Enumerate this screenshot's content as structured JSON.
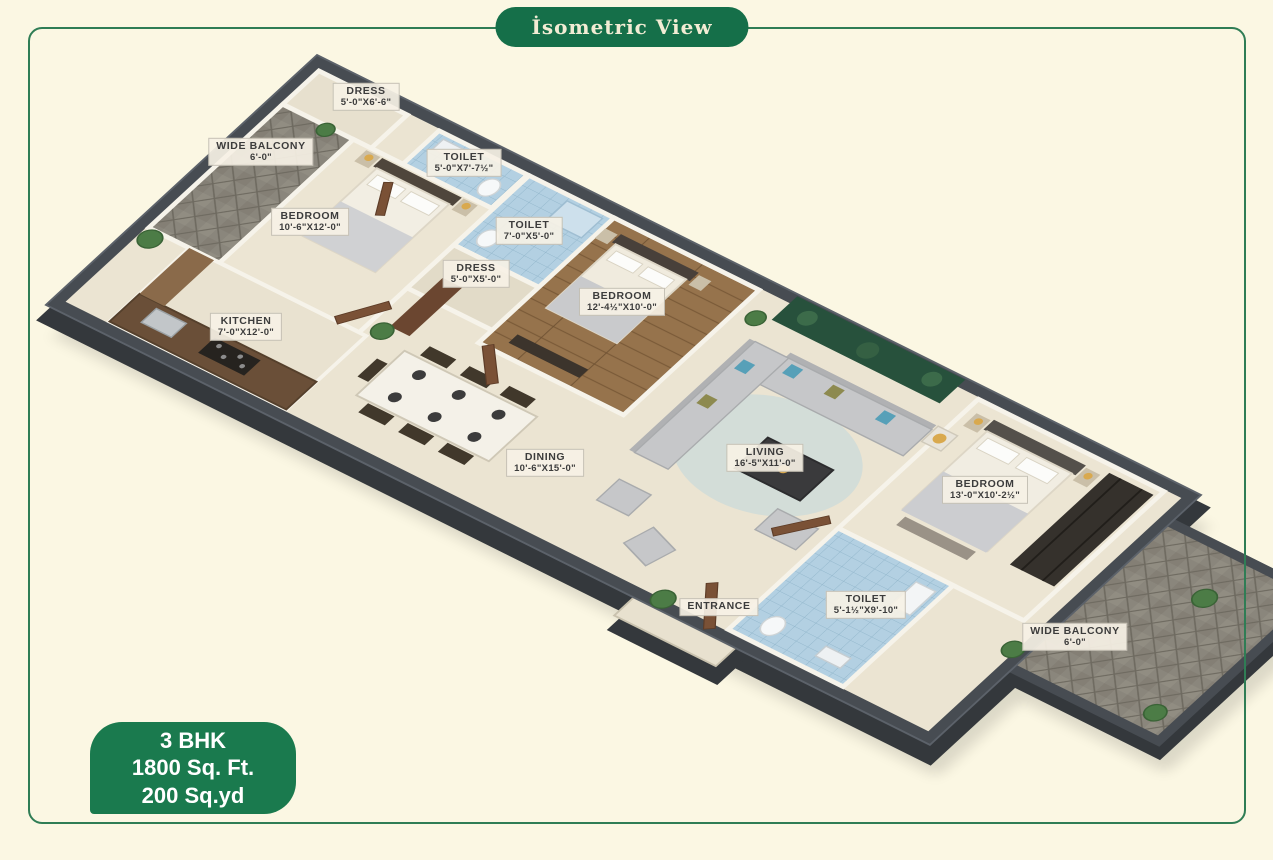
{
  "page": {
    "background": "#fbf7e3",
    "frame_color": "#2f7d55",
    "top_badge": {
      "label": "İsometric View",
      "bg": "#156f49",
      "text_color": "#f2ecd4"
    },
    "info_badge": {
      "lines": [
        "3 BHK",
        "1800 Sq. Ft.",
        "200 Sq.yd"
      ],
      "bg": "#1a7a4e",
      "text_color": "#ffffff"
    }
  },
  "floor_plan": {
    "rooms": [
      {
        "id": "dress-1",
        "name": "DRESS",
        "dims": "5'-0\"X6'-6\"",
        "label_x": 366,
        "label_y": 97
      },
      {
        "id": "wide-balcony-1",
        "name": "WIDE BALCONY",
        "dims": "6'-0\"",
        "label_x": 261,
        "label_y": 152
      },
      {
        "id": "toilet-1",
        "name": "TOILET",
        "dims": "5'-0\"X7'-7½\"",
        "label_x": 464,
        "label_y": 163
      },
      {
        "id": "bedroom-1",
        "name": "BEDROOM",
        "dims": "10'-6\"X12'-0\"",
        "label_x": 310,
        "label_y": 222
      },
      {
        "id": "toilet-2",
        "name": "TOILET",
        "dims": "7'-0\"X5'-0\"",
        "label_x": 529,
        "label_y": 231
      },
      {
        "id": "dress-2",
        "name": "DRESS",
        "dims": "5'-0\"X5'-0\"",
        "label_x": 476,
        "label_y": 274
      },
      {
        "id": "bedroom-2",
        "name": "BEDROOM",
        "dims": "12'-4½\"X10'-0\"",
        "label_x": 622,
        "label_y": 302
      },
      {
        "id": "kitchen",
        "name": "KITCHEN",
        "dims": "7'-0\"X12'-0\"",
        "label_x": 246,
        "label_y": 327
      },
      {
        "id": "dining",
        "name": "DINING",
        "dims": "10'-6\"X15'-0\"",
        "label_x": 545,
        "label_y": 463
      },
      {
        "id": "living",
        "name": "LIVING",
        "dims": "16'-5\"X11'-0\"",
        "label_x": 765,
        "label_y": 458
      },
      {
        "id": "bedroom-3",
        "name": "BEDROOM",
        "dims": "13'-0\"X10'-2½\"",
        "label_x": 985,
        "label_y": 490
      },
      {
        "id": "toilet-3",
        "name": "TOILET",
        "dims": "5'-1½\"X9'-10\"",
        "label_x": 866,
        "label_y": 605
      },
      {
        "id": "entrance",
        "name": "ENTRANCE",
        "dims": "",
        "label_x": 719,
        "label_y": 607
      },
      {
        "id": "wide-balcony-2",
        "name": "WIDE BALCONY",
        "dims": "6'-0\"",
        "label_x": 1075,
        "label_y": 637
      }
    ]
  }
}
